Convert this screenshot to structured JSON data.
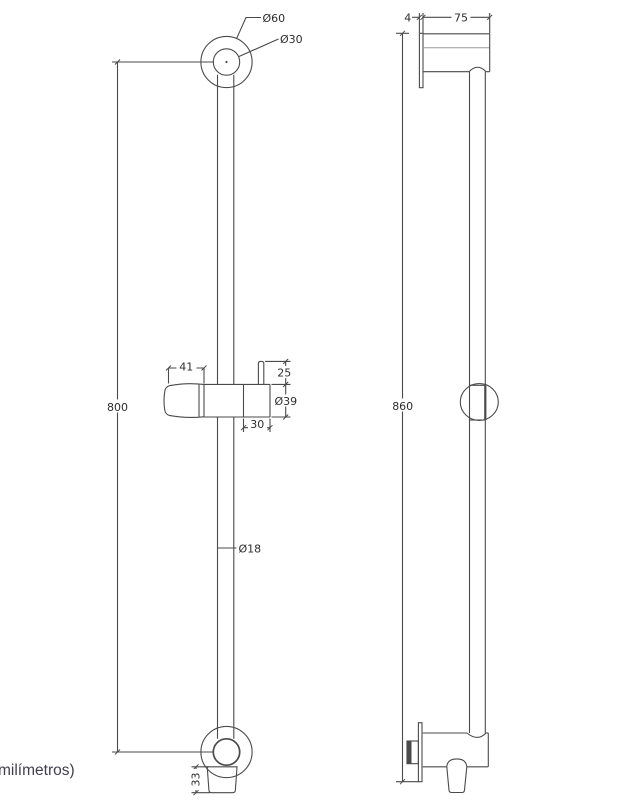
{
  "drawing": {
    "footer_note": "milímetros)",
    "front_view": {
      "labels": {
        "outer_flange_diameter": "Ø60",
        "inner_flange_diameter": "Ø30",
        "bar_center_distance": "800",
        "holder_grip_width": "41",
        "post_height": "25",
        "holder_diameter": "Ø39",
        "knob_width": "30",
        "bar_diameter": "Ø18",
        "outlet_height": "33"
      }
    },
    "side_view": {
      "labels": {
        "plate_thickness": "4",
        "wall_offset": "75",
        "overall_height": "860"
      }
    }
  },
  "theme": {
    "line": "#4a4a4a",
    "line_light": "#9b9b9b",
    "dim_text": "#2e2e2e",
    "note_text": "#3f3f4d",
    "background": "#ffffff"
  }
}
